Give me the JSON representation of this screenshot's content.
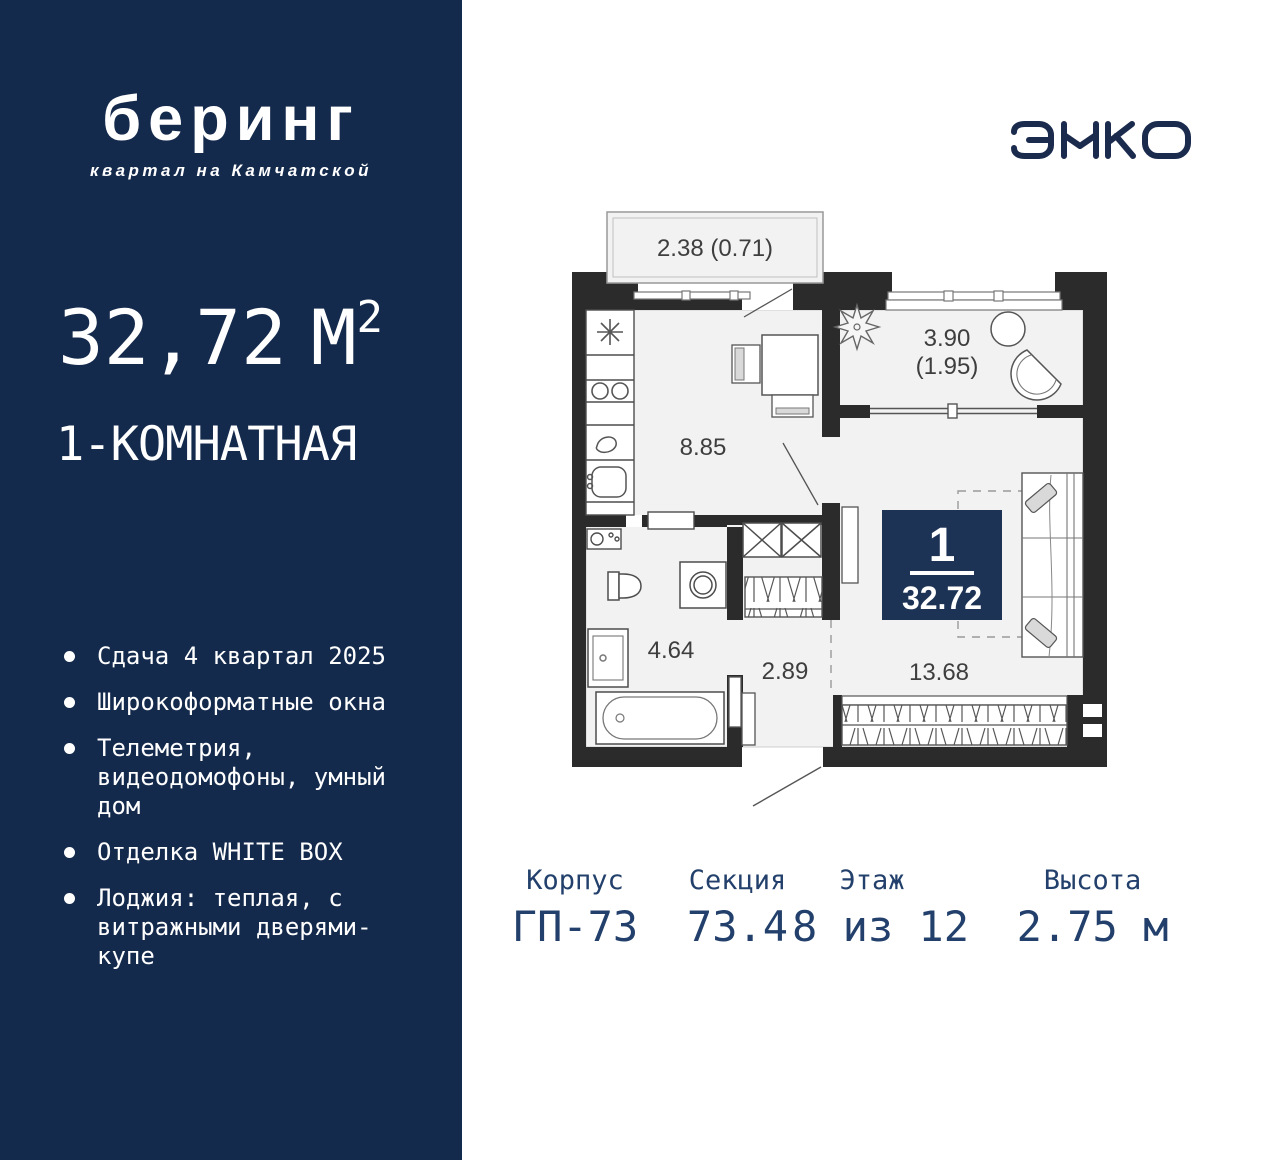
{
  "sidebar": {
    "logo": {
      "title": "беринг",
      "subtitle": "квартал на Камчатской"
    },
    "area": {
      "value": "32,72",
      "unit": "М",
      "sup": "2"
    },
    "type_label": "1-КОМНАТНАЯ",
    "features": [
      "Сдача 4 квартал 2025",
      "Широкоформатные окна",
      "Телеметрия, видеодомофоны, умный дом",
      "Отделка WHITE BOX",
      "Лоджия: теплая, с витражными дверями-купе"
    ]
  },
  "brand": {
    "name": "ЭНКО"
  },
  "plan": {
    "balcony_area": "2.38 (0.71)",
    "loggia_area": "3.90",
    "loggia_area_reduced": "(1.95)",
    "kitchen_living_area": "8.85",
    "bathroom_area": "4.64",
    "hallway_area": "2.89",
    "bedroom_area": "13.68",
    "badge": {
      "rooms": "1",
      "total_area": "32.72"
    }
  },
  "details": {
    "items": [
      {
        "label": "Корпус",
        "value": "ГП-73"
      },
      {
        "label": "Секция",
        "value": "73.4"
      },
      {
        "label": "Этаж",
        "value": "8 из 12"
      },
      {
        "label": "Высота",
        "value": "2.75 м"
      }
    ]
  },
  "colors": {
    "sidebar_bg": "#142A4C",
    "badge_bg": "#1C3356",
    "navy_text": "#22406B",
    "wall": "#2B2B2B",
    "room_fill": "#F2F2F3"
  }
}
